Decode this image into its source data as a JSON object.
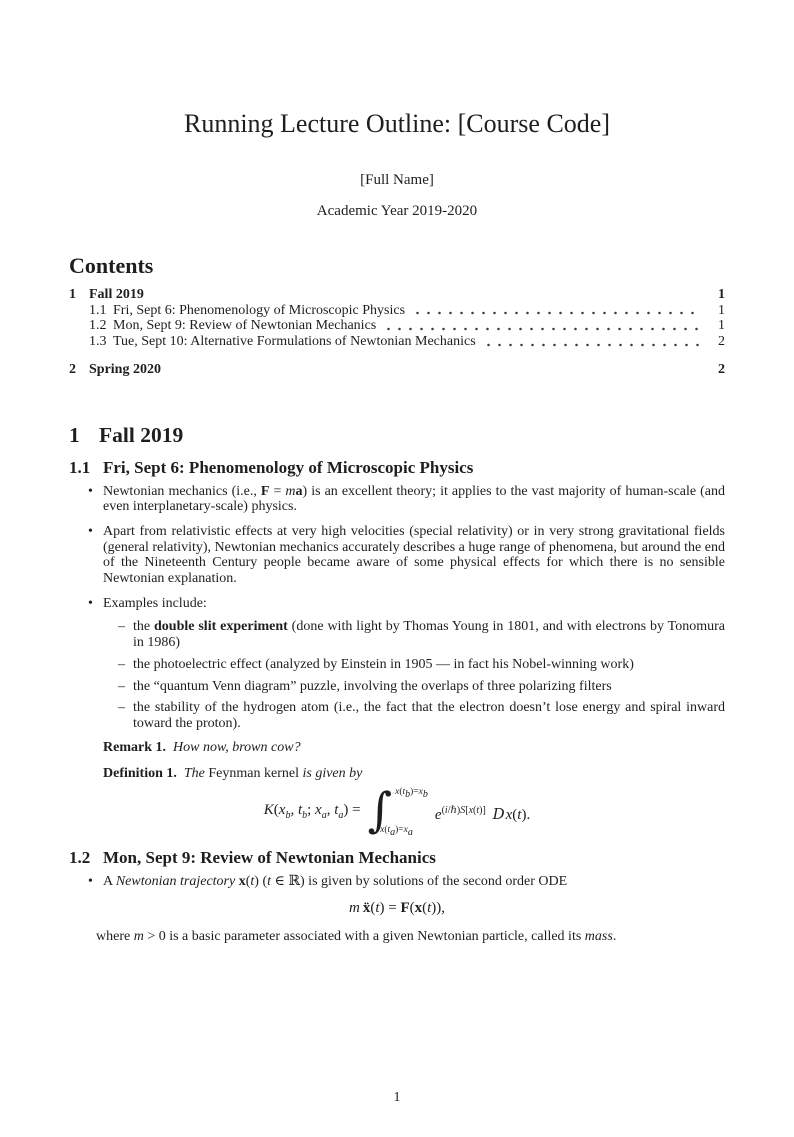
{
  "header": {
    "title": "Running Lecture Outline: [Course Code]",
    "author": "[Full Name]",
    "date": "Academic Year 2019-2020"
  },
  "markers": {
    "bullet": "•",
    "dash": "–"
  },
  "contents": {
    "heading": "Contents",
    "entries": [
      {
        "number": "1",
        "title": "Fall 2019",
        "page": "1"
      },
      {
        "number": "1.1",
        "title": "Fri, Sept 6: Phenomenology of Microscopic Physics",
        "page": "1"
      },
      {
        "number": "1.2",
        "title": "Mon, Sept 9: Review of Newtonian Mechanics",
        "page": "1"
      },
      {
        "number": "1.3",
        "title": "Tue, Sept 10: Alternative Formulations of Newtonian Mechanics",
        "page": "2"
      },
      {
        "number": "2",
        "title": "Spring 2020",
        "page": "2"
      }
    ]
  },
  "section1": {
    "number": "1",
    "title": "Fall 2019"
  },
  "sub11": {
    "number": "1.1",
    "title": "Fri, Sept 6: Phenomenology of Microscopic Physics",
    "bullet1": "Newtonian mechanics (i.e., <b>F</b> = <i>m</i><b>a</b>) is an excellent theory; it applies to the vast majority of human-scale (and even interplanetary-scale) physics.",
    "bullet2": "Apart from relativistic effects at very high velocities (special relativity) or in very strong gravitational fields (general relativity), Newtonian mechanics accurately describes a huge range of phenomena, but around the end of the Nineteenth Century people became aware of some physical effects for which there is no sensible Newtonian explanation.",
    "bullet3": "Examples include:",
    "sub1": "the <b>double slit experiment</b> (done with light by Thomas Young in 1801, and with electrons by Tonomura in 1986)",
    "sub2": "the photoelectric effect (analyzed by Einstein in 1905 — in fact his Nobel-winning work)",
    "sub3": "the “quantum Venn diagram” puzzle, involving the overlaps of three polarizing filters",
    "sub4": "the stability of the hydrogen atom (i.e., the fact that the electron doesn’t lose energy and spiral inward toward the proton).",
    "remark_label": "Remark 1.",
    "remark_body": "<i>How now, brown cow?</i>",
    "definition_label": "Definition 1.",
    "definition_body": "<i>The</i> Feynman kernel <i>is given by</i>",
    "formula": {
      "lhs": "<i>K</i>(<i>x</i><sub><i>b</i></sub>, <i>t</i><sub><i>b</i></sub>; <i>x</i><sub><i>a</i></sub>, <i>t</i><sub><i>a</i></sub>) =",
      "integral_sign": "∫",
      "upper_limit": "<i>x</i>(<i>t</i><sub><i>b</i></sub>)=<i>x</i><sub><i>b</i></sub>",
      "lower_limit": "<i>x</i>(<i>t</i><sub><i>a</i></sub>)=<i>x</i><sub><i>a</i></sub>",
      "integrand": "<i>e</i><sup>(<i>i</i>/ℏ)<i>S</i>[<i>x</i>(<i>t</i>)]</sup>&nbsp;<span class=\"scrD\"><i>D</i></span><i>x</i>(<i>t</i>)."
    }
  },
  "sub12": {
    "number": "1.2",
    "title": "Mon, Sept 9: Review of Newtonian Mechanics",
    "bullet1": "A <i>Newtonian trajectory</i> <b>x</b>(<i>t</i>) (<i>t</i> ∈ ℝ) is given by solutions of the second order ODE",
    "formula": "<i>m</i>&thinsp;<b>ẍ</b>(<i>t</i>) = <b>F</b>(<b>x</b>(<i>t</i>)),",
    "after": "where <i>m</i> &gt; 0 is a basic parameter associated with a given Newtonian particle, called its <i>mass</i>."
  },
  "footer": {
    "page_number": "1"
  }
}
